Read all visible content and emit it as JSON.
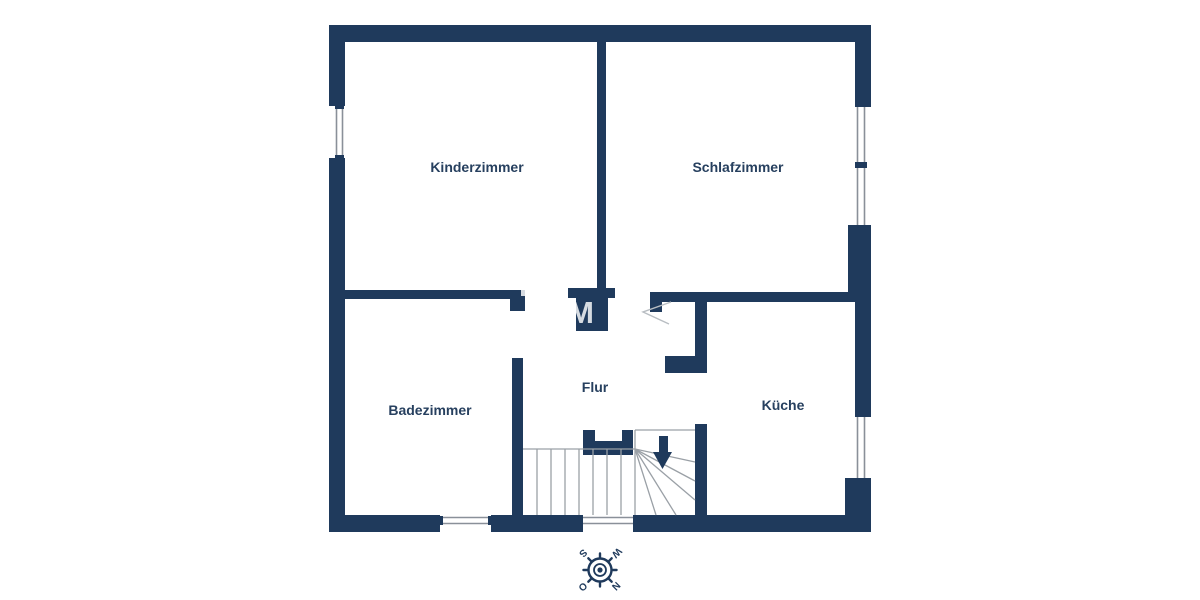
{
  "plan": {
    "type": "floor-plan",
    "rooms": [
      {
        "id": "kinderzimmer",
        "label": "Kinderzimmer"
      },
      {
        "id": "schlafzimmer",
        "label": "Schlafzimmer"
      },
      {
        "id": "badezimmer",
        "label": "Badezimmer"
      },
      {
        "id": "flur",
        "label": "Flur"
      },
      {
        "id": "kueche",
        "label": "Küche"
      }
    ],
    "watermark_visible_text": "OM",
    "compass": {
      "north": "N",
      "east": "O",
      "south": "S",
      "west": "W"
    },
    "colors": {
      "wall": "#1F3A5C",
      "background": "#FFFFFF",
      "stair_line": "#9AA0A6",
      "window_line": "#8A9099",
      "door_swing": "#B8BDC2",
      "label_text": "#27405F",
      "watermark": "#FFFFFF"
    }
  }
}
